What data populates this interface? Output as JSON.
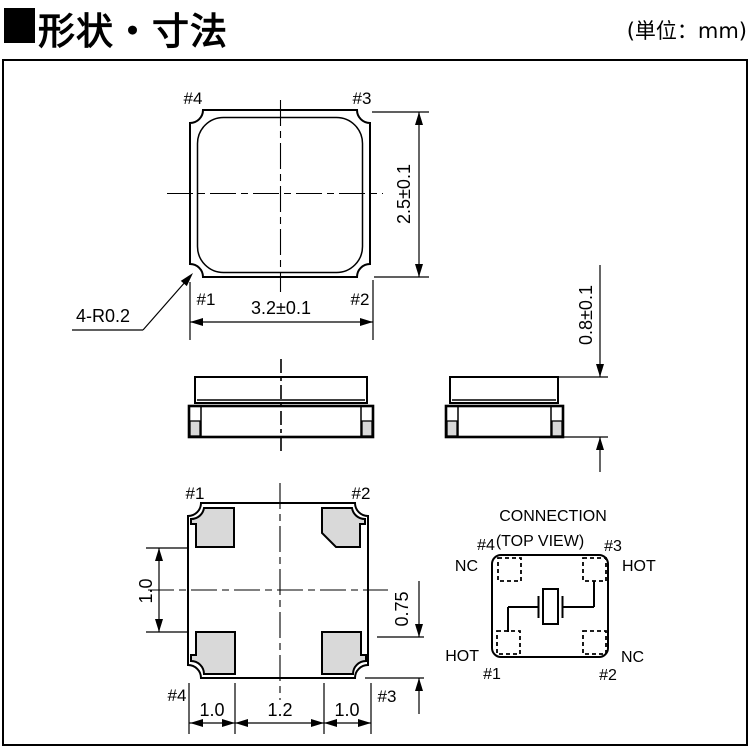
{
  "header": {
    "title": "形状・寸法",
    "unit": "(単位：mm)"
  },
  "top_view": {
    "pin_top_left": "#4",
    "pin_top_right": "#3",
    "pin_bottom_left": "#1",
    "pin_bottom_right": "#2",
    "dim_height": "2.5±0.1",
    "dim_width": "3.2±0.1",
    "corner_note": "4-R0.2"
  },
  "side_view": {
    "dim_thickness": "0.8±0.1"
  },
  "bottom_view": {
    "pin_top_left": "#1",
    "pin_top_right": "#2",
    "pin_bottom_left": "#4",
    "pin_bottom_right": "#3",
    "dim_gap_vertical": "1.0",
    "dim_pad_height": "0.75",
    "dim_pad_width_left": "1.0",
    "dim_center_span": "1.2",
    "dim_pad_width_right": "1.0"
  },
  "connection": {
    "title": "CONNECTION",
    "subtitle": "(TOP VIEW)",
    "pin4": "#4",
    "pin3": "#3",
    "pin1": "#1",
    "pin2": "#2",
    "signal4": "NC",
    "signal3": "HOT",
    "signal1": "HOT",
    "signal2": "NC"
  },
  "colors": {
    "line": "#000000",
    "pad_fill": "#d9d9d9",
    "background": "#ffffff"
  }
}
